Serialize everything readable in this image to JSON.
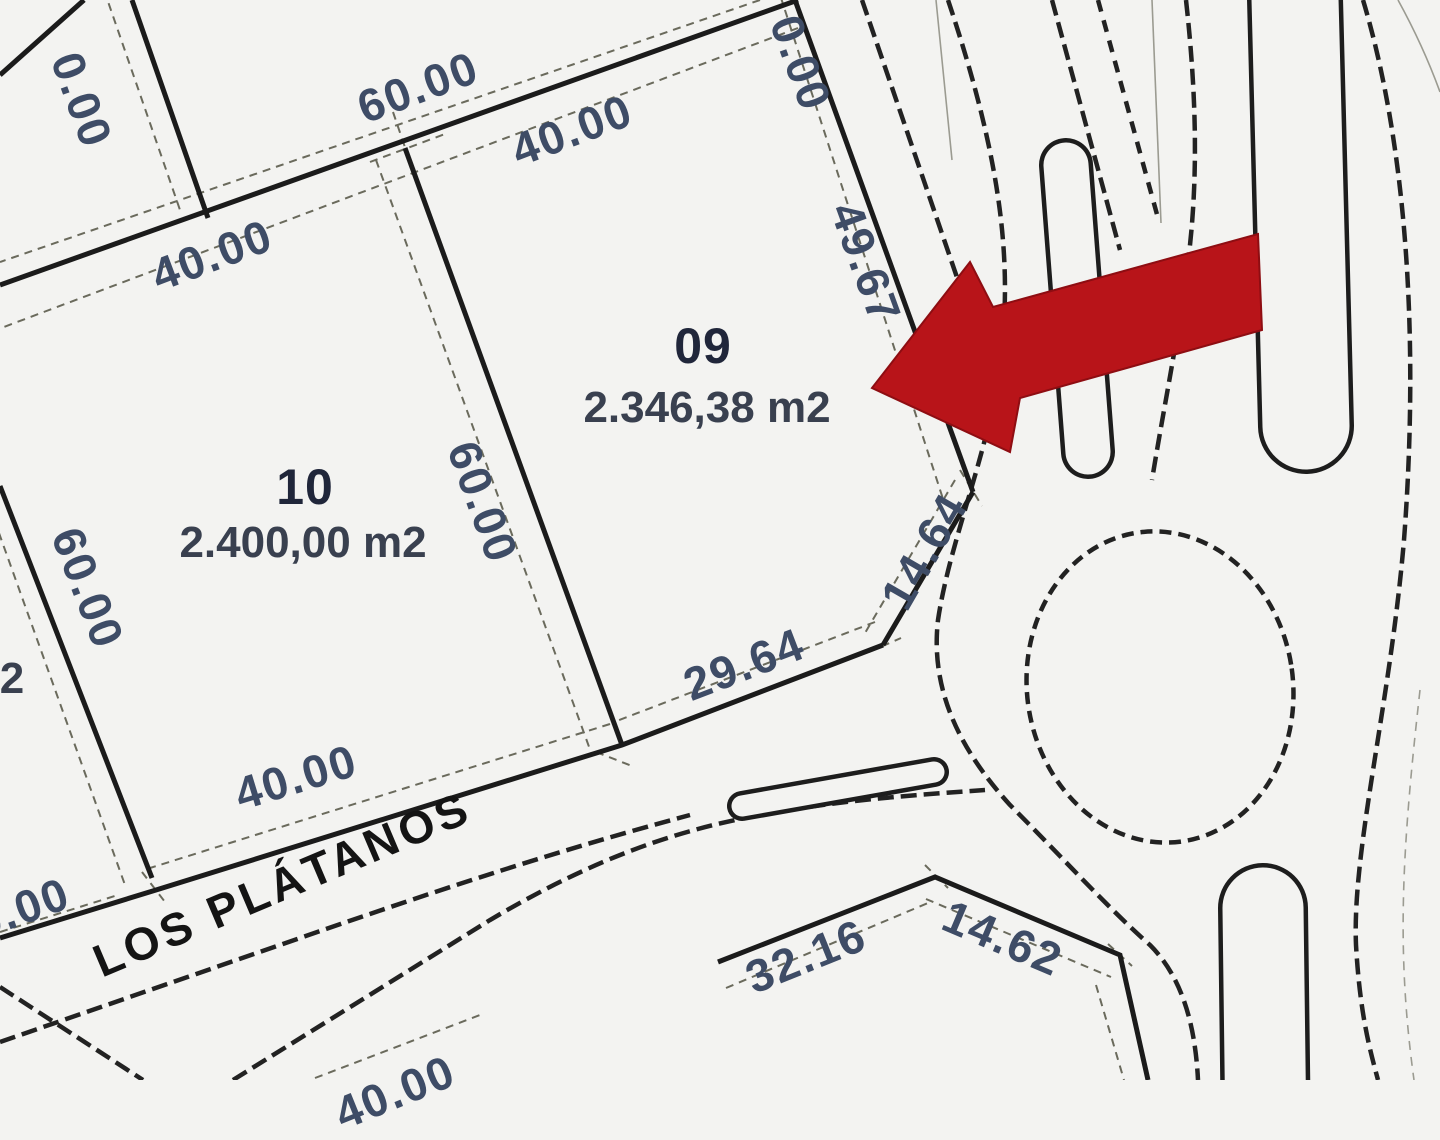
{
  "title": "Cadastral lot plan with highlighted lot 09",
  "street": {
    "name": "LOS PLÁTANOS"
  },
  "lots": {
    "lot10": {
      "number": "10",
      "area": "2.400,00 m2"
    },
    "lot09": {
      "number": "09",
      "area": "2.346,38 m2"
    }
  },
  "dimensions": {
    "rear_block": "60.00",
    "lot09_top": "40.00",
    "lot10_top": "40.00",
    "lot10_west": "60.00",
    "shared_side": "60.00",
    "lot09_east": "49.67",
    "lot09_chamfer": "14.64",
    "lot09_bottom": "29.64",
    "lot10_frontage": "40.00",
    "south_lot_frontage": "32.16",
    "south_lot_chamfer": "14.62"
  },
  "fragments": {
    "top_left": "0.00",
    "top_right": "0.00",
    "bottom_left": "0.00",
    "bottom_edge": "40.00",
    "west_lot_area_cut": "2"
  },
  "marker": {
    "type": "red-arrow",
    "points_at": "lot09",
    "color": "#b81419"
  },
  "colors": {
    "background": "#f3f3f1",
    "lot_line": "#1b1b1b",
    "road_line": "#222222",
    "dimension_line": "#6a6a5c",
    "dimension_text": "#3e4c66",
    "lot_text": "#20263a",
    "street_text": "#141414",
    "arrow": "#b81419"
  }
}
